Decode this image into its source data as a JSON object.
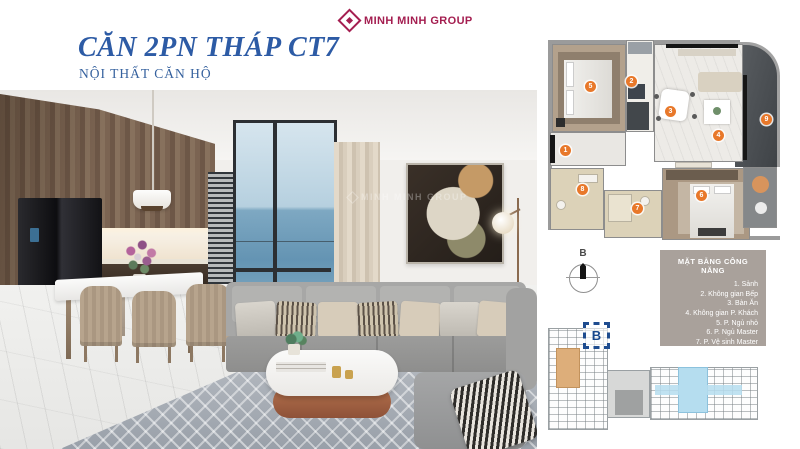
{
  "header": {
    "title": "CĂN 2PN THÁP CT7",
    "subtitle": "NỘI THẤT CĂN HỘ"
  },
  "brand": {
    "name": "MINH MINH GROUP",
    "color": "#a41e50"
  },
  "colors": {
    "title_blue": "#2d5ba5",
    "brand_crimson": "#a41e50",
    "marker_orange": "#e8782a",
    "legend_bg": "#a9a19b",
    "unit_b_navy": "#1e4c8f",
    "site_highlight_tan": "#ddae7a",
    "site_highlight_blue": "#b5ddef"
  },
  "photo": {
    "watermark": "MINH MINH GROUP"
  },
  "floorplan": {
    "markers": [
      {
        "num": "1",
        "room": "Sảnh"
      },
      {
        "num": "2",
        "room": "Không gian Bếp"
      },
      {
        "num": "3",
        "room": "Bàn Ăn"
      },
      {
        "num": "4",
        "room": "Không gian P. Khách"
      },
      {
        "num": "5",
        "room": "P. Ngủ nhỏ"
      },
      {
        "num": "6",
        "room": "P. Ngủ Master"
      },
      {
        "num": "7",
        "room": "P. Vệ sinh Master"
      },
      {
        "num": "8",
        "room": "P. Vệ sinh chung+Giặt"
      },
      {
        "num": "9",
        "room": "Logia"
      }
    ]
  },
  "legend": {
    "title": "MẶT BẰNG CÔNG NĂNG",
    "items": [
      "1. Sảnh",
      "2. Không gian Bếp",
      "3. Bàn Ăn",
      "4. Không gian P. Khách",
      "5. P. Ngủ nhỏ",
      "6. P. Ngủ Master",
      "7. P. Vệ sinh Master",
      "8. P. Vệ sinh chung+Giặt",
      "9. Logia"
    ]
  },
  "compass": {
    "label": "B"
  },
  "site": {
    "unit_label": "B"
  }
}
